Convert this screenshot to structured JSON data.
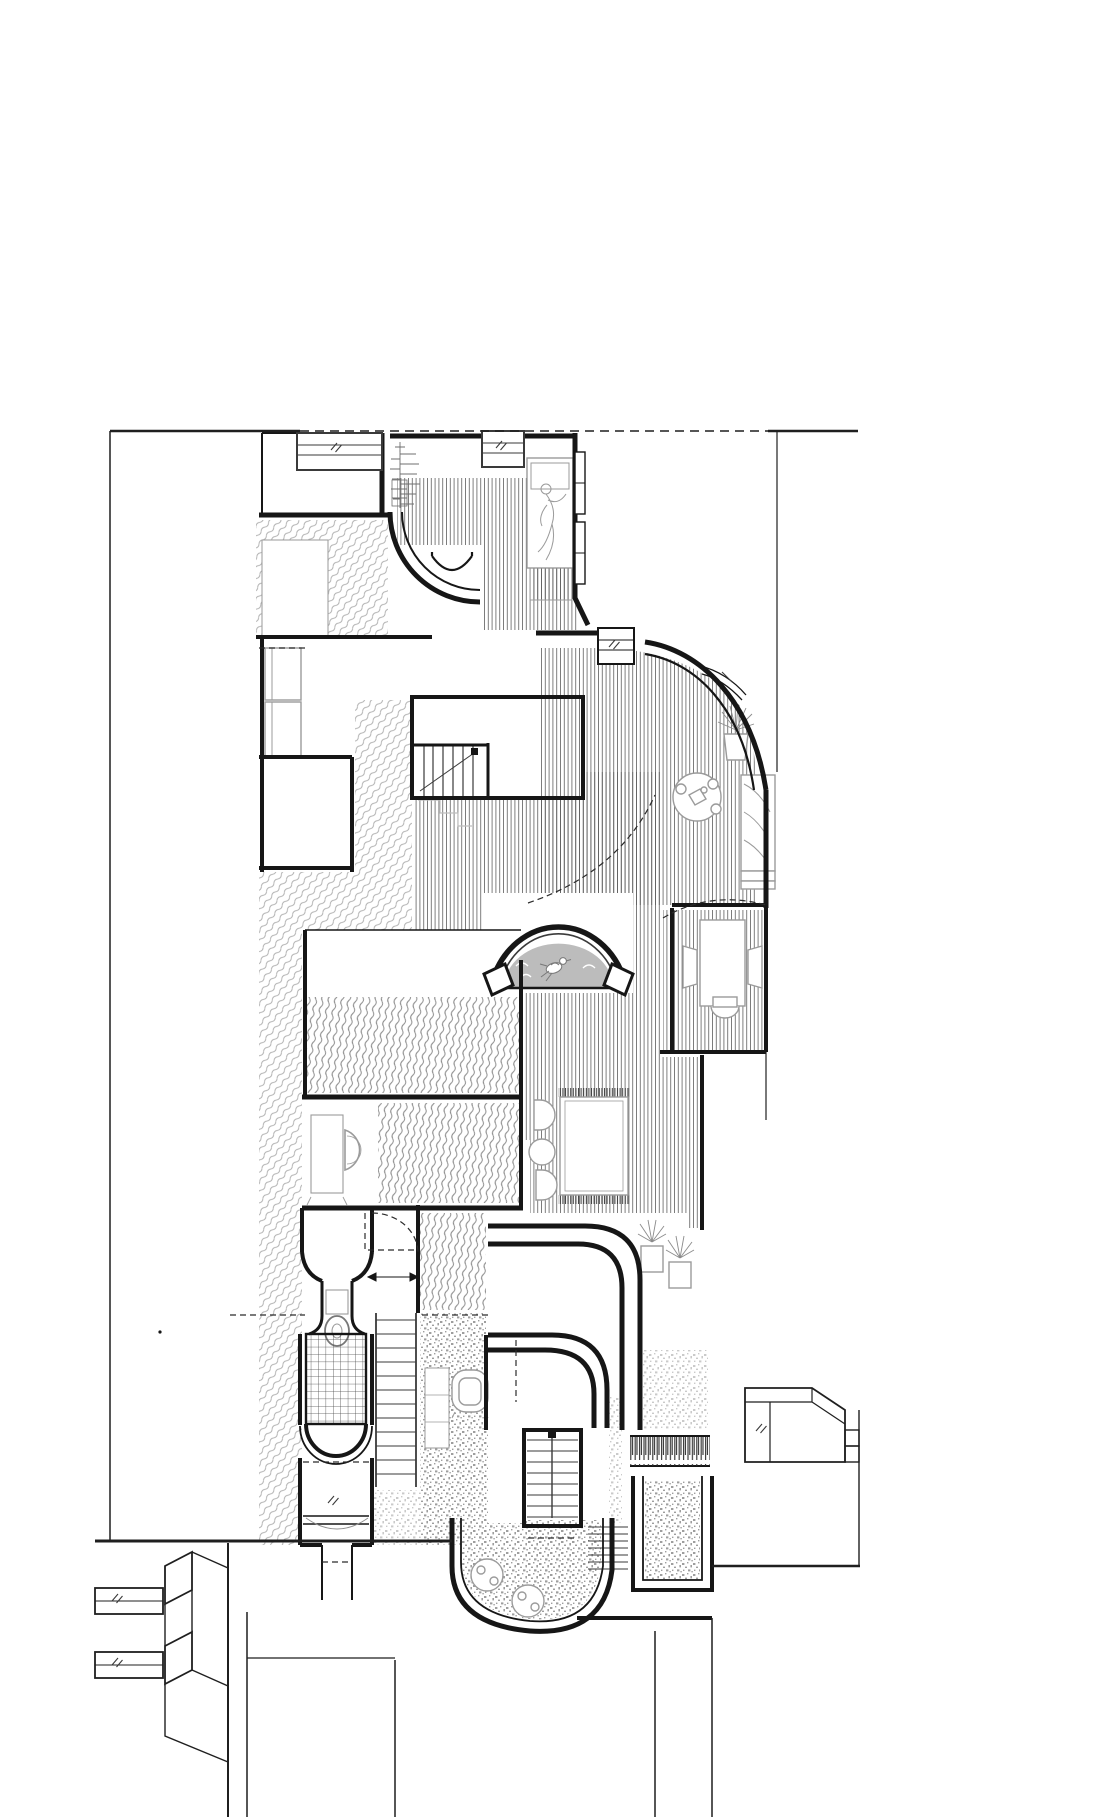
{
  "document": {
    "kind": "architectural-floor-plan",
    "description": "Black and white measured floor plan of a narrow town house with curved interior walls, hatched floor finishes, furniture symbols, three stair flights, an arched niche and street frontage with neighbouring buildings",
    "visible_text": []
  },
  "colors": {
    "background": "#ffffff",
    "wall": "#161616",
    "thin": "#3a3a3a",
    "site": "#1f1f1f",
    "dash": "#2b2b2b",
    "furniture": "#9b9b9b",
    "furniture_dark": "#777777",
    "ghost": "#bdbdbd",
    "niche_fill": "#bcbcbc",
    "niche_edge": "#999999",
    "hatch_floor": "#5f5f5f",
    "hatch_party": "#b0b0b0",
    "hatch_terrace": "#8c8c8c",
    "tile_line": "#4a4a4a",
    "stipple_dark": "#9e9e9e",
    "stipple_light": "#cacaca",
    "fence": "#2e2e2e",
    "fringe": "#3c3c3c",
    "white": "#ffffff"
  },
  "rooms": [
    {
      "id": "bedroom",
      "label": "bedroom with bed and reclining figure"
    },
    {
      "id": "stair-hall",
      "label": "stair hall with curved wall"
    },
    {
      "id": "living-room",
      "label": "living room with curved glazed bay"
    },
    {
      "id": "study-nook",
      "label": "study nook with desk and chairs"
    },
    {
      "id": "gallery-hall",
      "label": "gallery hall with timber floor"
    },
    {
      "id": "arch-niche",
      "label": "arched niche with bird ornament"
    },
    {
      "id": "bathroom",
      "label": "bathroom with washbasin console"
    },
    {
      "id": "shower-room",
      "label": "tiled shower room"
    },
    {
      "id": "bay-window-room",
      "label": "street bay window"
    },
    {
      "id": "window-seat-room",
      "label": "room with window seat sofas"
    },
    {
      "id": "rug-lounge",
      "label": "lounge with fringed rug and chairs"
    },
    {
      "id": "garden-terrace",
      "label": "lower garden terrace"
    },
    {
      "id": "entry-court",
      "label": "entry court and street"
    }
  ],
  "furniture": [
    {
      "id": "bed-with-figure",
      "label": "double bed with person"
    },
    {
      "id": "branch-plant",
      "label": "branch plant at bedroom window"
    },
    {
      "id": "window-seat-sofa",
      "label": "two window seat sofas"
    },
    {
      "id": "round-tea-table",
      "label": "round table with tea set and stools"
    },
    {
      "id": "bay-sofa",
      "label": "sofa in glazed bay"
    },
    {
      "id": "potted-plant",
      "label": "potted plant"
    },
    {
      "id": "desk-and-chairs",
      "label": "desk with three chairs"
    },
    {
      "id": "fringed-rug",
      "label": "area rug with fringe"
    },
    {
      "id": "lounge-chairs",
      "label": "pair of lounge chairs and stool"
    },
    {
      "id": "twin-plants",
      "label": "twin potted plants"
    },
    {
      "id": "washbasin-console",
      "label": "washbasin console"
    },
    {
      "id": "wc-fixture",
      "label": "WC / shower fixture"
    },
    {
      "id": "armchair",
      "label": "armchair with side table"
    },
    {
      "id": "cafe-tables",
      "label": "two round cafe tables"
    },
    {
      "id": "bird-ornament",
      "label": "perched bird ornament in niche"
    }
  ],
  "stairs": [
    {
      "id": "main-flight",
      "label": "main flight up, 7 treads with direction arrow"
    },
    {
      "id": "long-flight",
      "label": "long side flight, 12 treads"
    },
    {
      "id": "garden-flight",
      "label": "garden flight down with centre newel"
    },
    {
      "id": "garden-steps",
      "label": "side garden steps"
    }
  ],
  "site": [
    {
      "id": "property-line",
      "label": "dashed property line"
    },
    {
      "id": "party-hatch",
      "label": "party wall wavy hatch"
    },
    {
      "id": "neighbour-left",
      "label": "left neighbour bay windows"
    },
    {
      "id": "neighbour-right",
      "label": "right neighbour block"
    },
    {
      "id": "balustrade",
      "label": "balustrade fence"
    },
    {
      "id": "planter",
      "label": "masonry planter"
    }
  ]
}
